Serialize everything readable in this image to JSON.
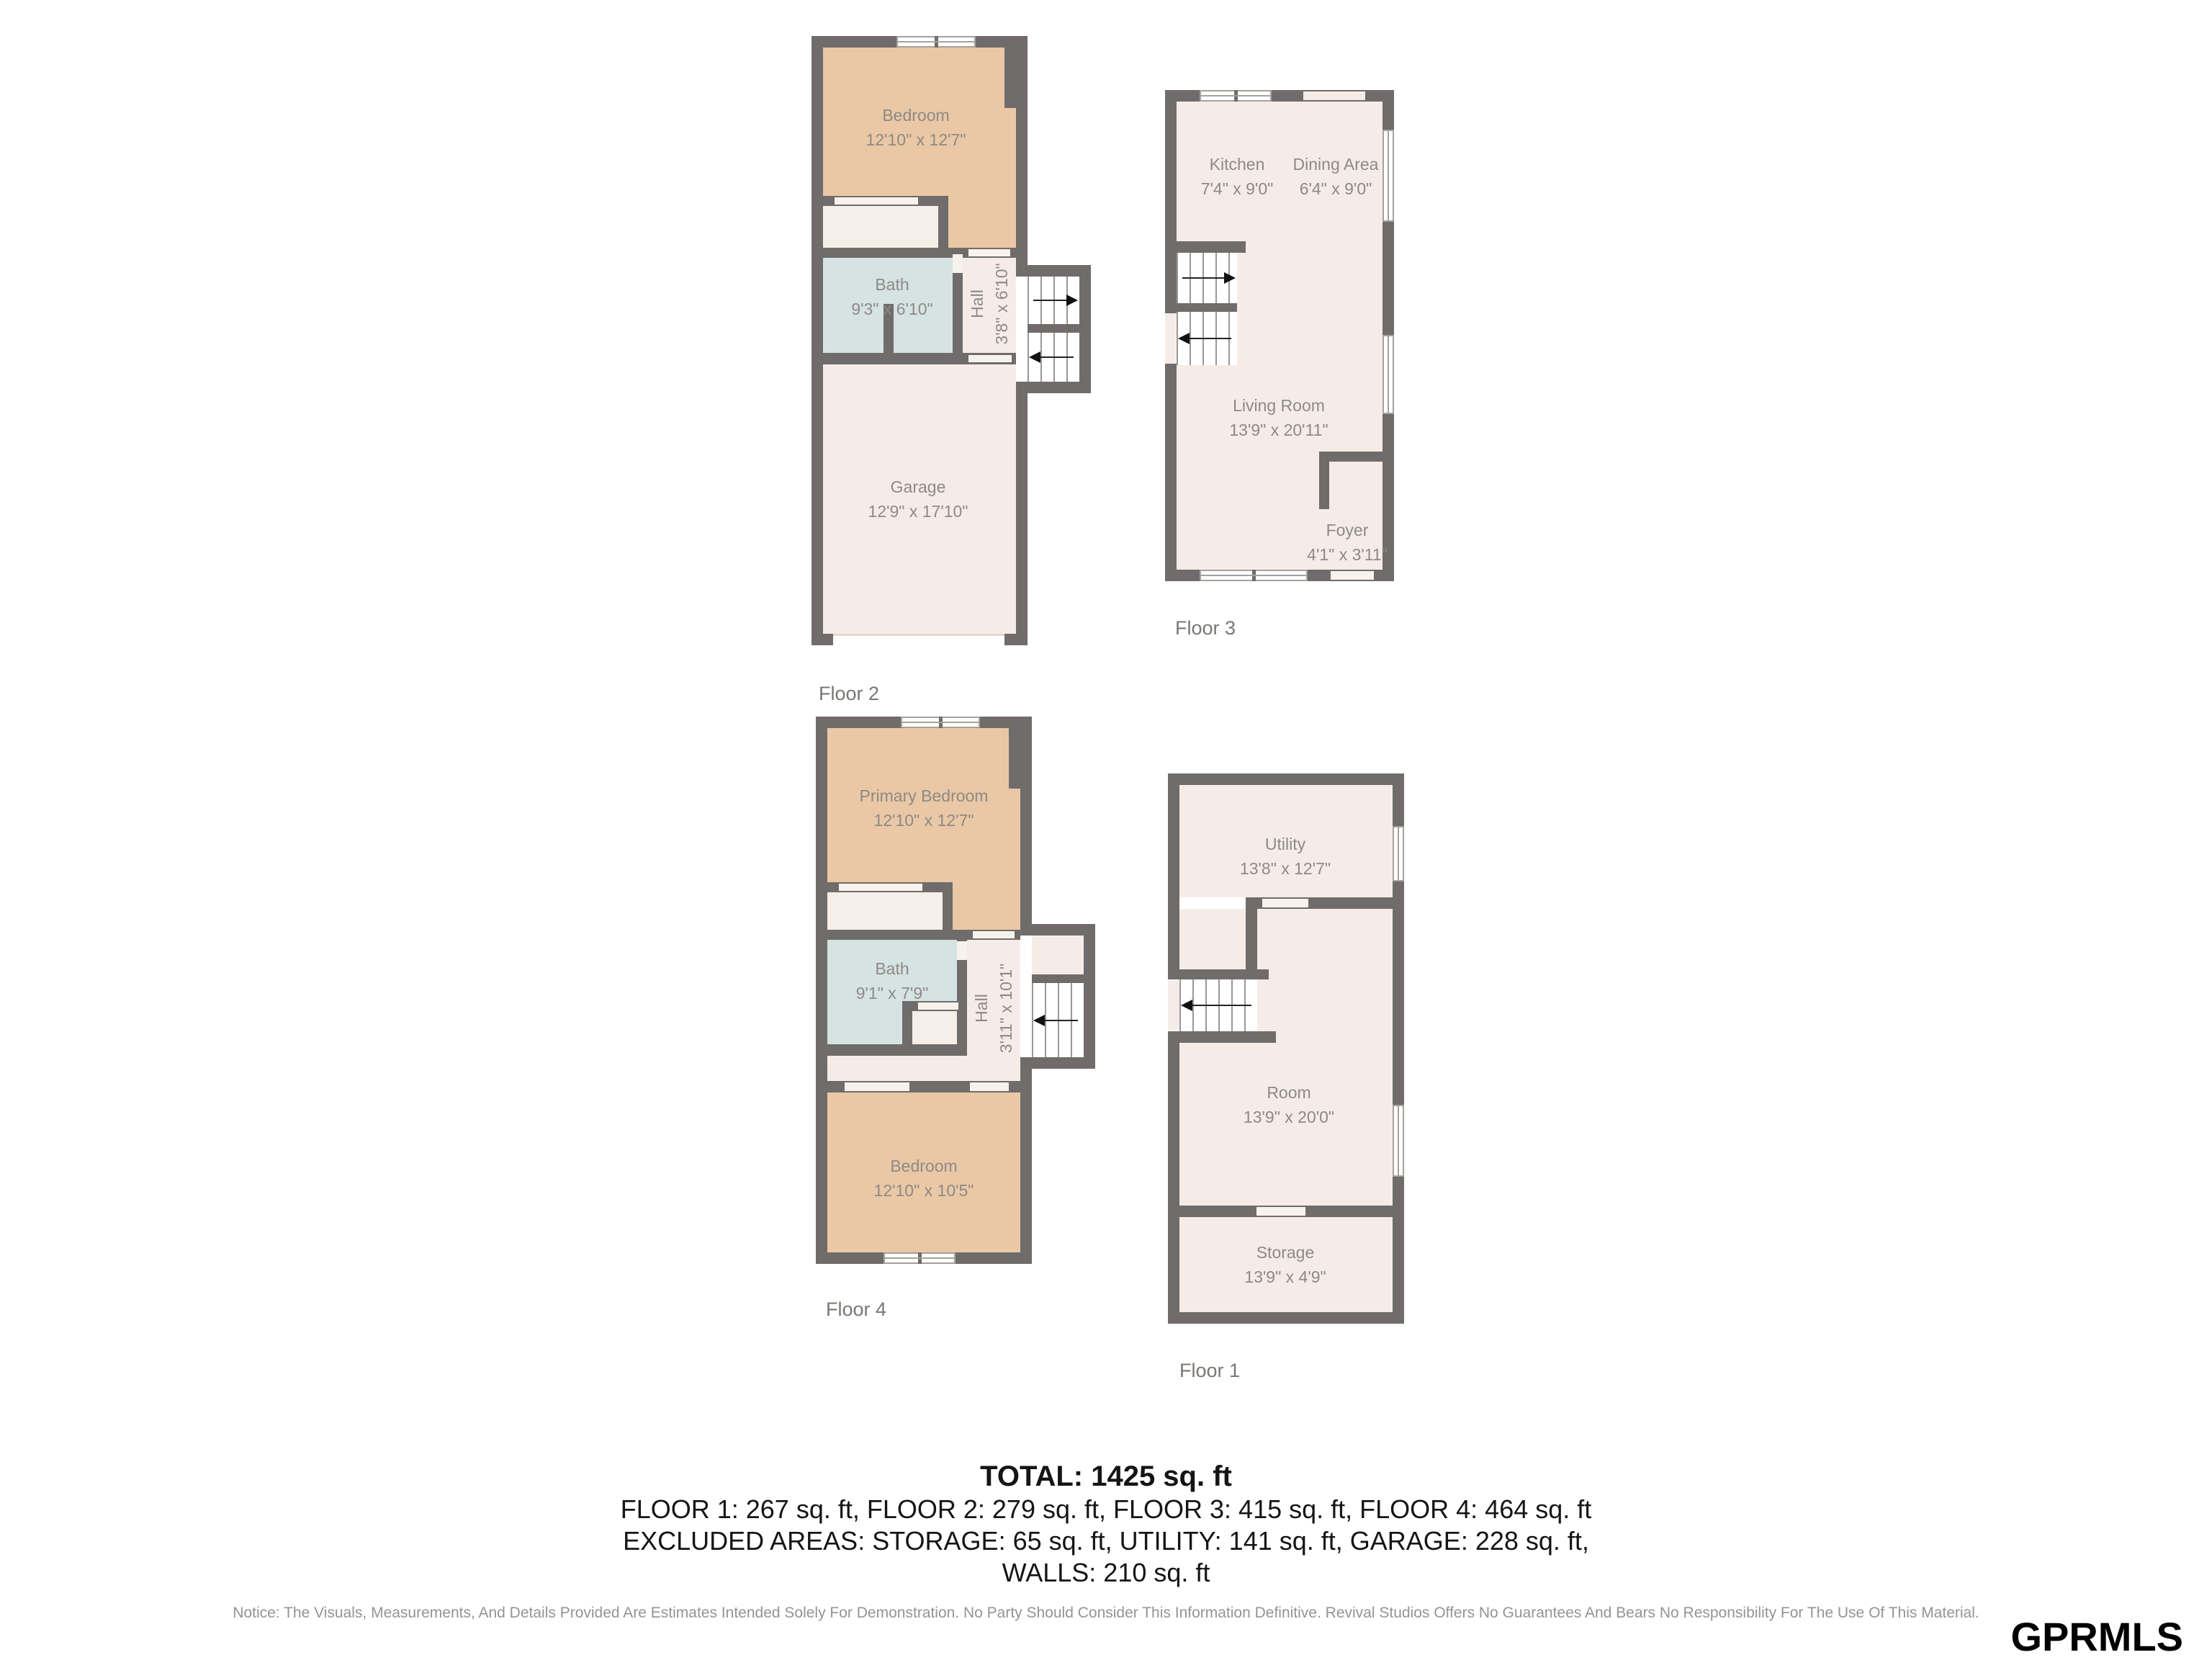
{
  "branding": {
    "logo_text": "GPRMLS"
  },
  "plans": {
    "floor2": {
      "label": "Floor 2",
      "rooms": {
        "bedroom": {
          "name": "Bedroom",
          "dims": "12'10\" x 12'7\""
        },
        "bath": {
          "name": "Bath",
          "dims": "9'3\" x 6'10\""
        },
        "hall": {
          "name": "Hall",
          "dims": "3'8\" x 6'10\""
        },
        "garage": {
          "name": "Garage",
          "dims": "12'9\" x 17'10\""
        }
      }
    },
    "floor3": {
      "label": "Floor 3",
      "rooms": {
        "kitchen": {
          "name": "Kitchen",
          "dims": "7'4\" x 9'0\""
        },
        "dining": {
          "name": "Dining Area",
          "dims": "6'4\" x 9'0\""
        },
        "living": {
          "name": "Living Room",
          "dims": "13'9\" x 20'11\""
        },
        "foyer": {
          "name": "Foyer",
          "dims": "4'1\" x 3'11\""
        }
      }
    },
    "floor4": {
      "label": "Floor 4",
      "rooms": {
        "primary": {
          "name": "Primary Bedroom",
          "dims": "12'10\" x 12'7\""
        },
        "bath": {
          "name": "Bath",
          "dims": "9'1\" x 7'9\""
        },
        "hall": {
          "name": "Hall",
          "dims": "3'11\" x 10'1\""
        },
        "bedroom": {
          "name": "Bedroom",
          "dims": "12'10\" x 10'5\""
        }
      }
    },
    "floor1": {
      "label": "Floor 1",
      "rooms": {
        "utility": {
          "name": "Utility",
          "dims": "13'8\" x 12'7\""
        },
        "room": {
          "name": "Room",
          "dims": "13'9\" x 20'0\""
        },
        "storage": {
          "name": "Storage",
          "dims": "13'9\" x 4'9\""
        }
      }
    }
  },
  "summary": {
    "total": "TOTAL: 1425 sq. ft",
    "floors": "FLOOR 1: 267 sq. ft, FLOOR 2: 279 sq. ft, FLOOR 3: 415 sq. ft, FLOOR 4: 464 sq. ft",
    "excluded": "EXCLUDED AREAS: STORAGE: 65 sq. ft, UTILITY: 141 sq. ft, GARAGE: 228 sq. ft,",
    "walls": "WALLS: 210 sq. ft"
  },
  "notice": "Notice: The Visuals, Measurements, And Details Provided Are Estimates Intended Solely For Demonstration. No Party Should Consider This Information Definitive. Revival Studios Offers No Guarantees And Bears No Responsibility For The Use Of This Material.",
  "colors": {
    "wall": "#6f6c6b",
    "bedroom": "#eac8a5",
    "bath": "#d5e3e2",
    "room": "#f6ece7",
    "accent_text": "#8d8a86"
  }
}
